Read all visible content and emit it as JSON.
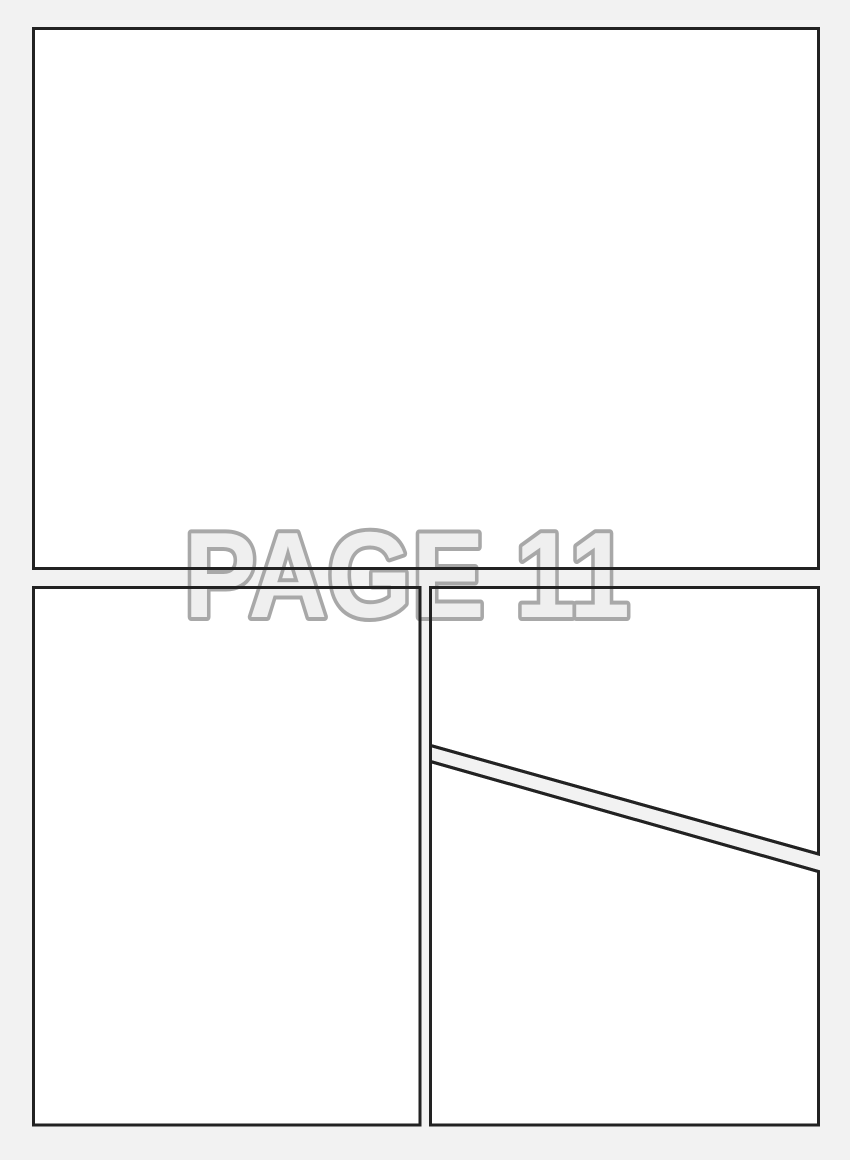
{
  "page": {
    "watermark_label": "PAGE 11"
  },
  "colors": {
    "background": "#f2f2f2",
    "panel_fill": "#ffffff",
    "panel_border": "#222222",
    "watermark_fill": "#efefef",
    "watermark_outline": "#a8a8a8"
  }
}
